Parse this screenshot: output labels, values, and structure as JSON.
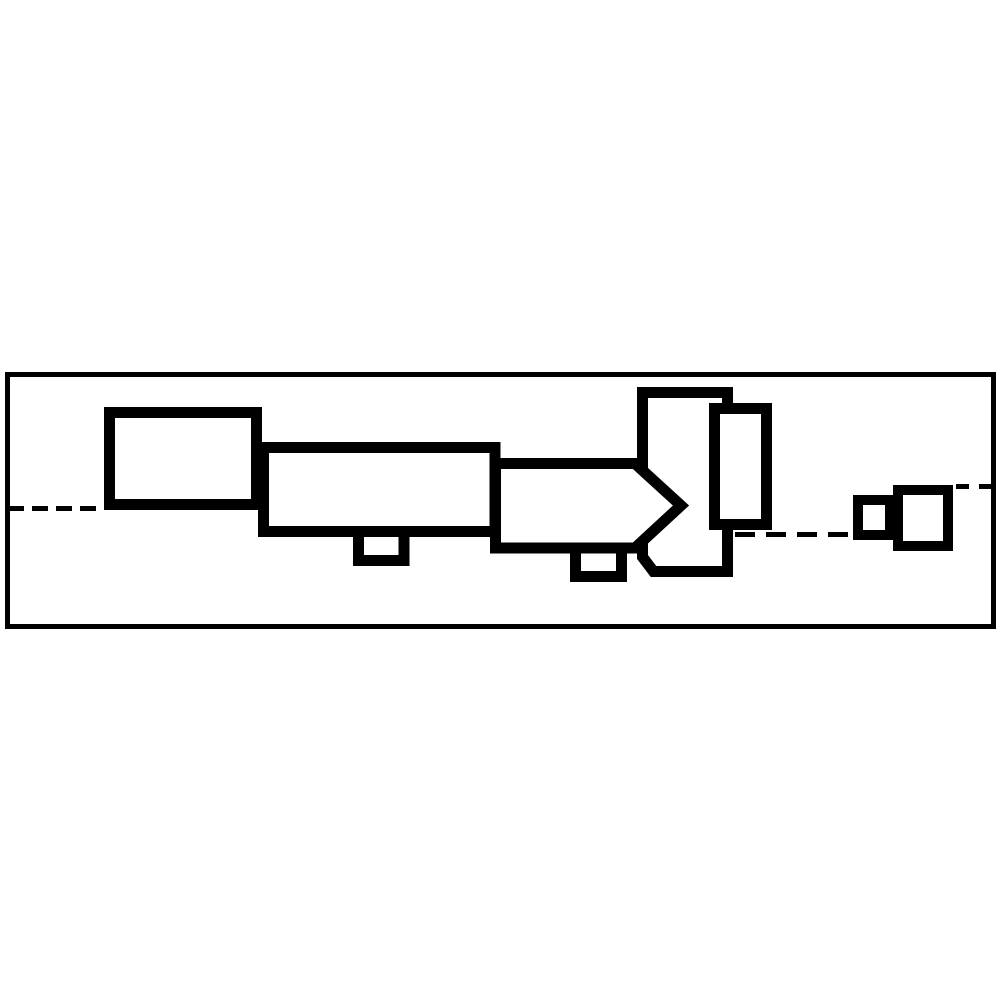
{
  "figure": {
    "canvas": {
      "width": 1000,
      "height": 1000,
      "background": "#ffffff"
    },
    "ink_color": "#000000",
    "border": {
      "x": 7.5,
      "y": 374.5,
      "width": 986,
      "height": 252,
      "stroke_width": 5
    },
    "centerlines": [
      {
        "name": "centerline-left",
        "x1": 8,
        "y1": 508.5,
        "x2": 104,
        "y2": 508.5,
        "dash": "16 8",
        "stroke_width": 5
      },
      {
        "name": "centerline-middle",
        "x1": 735,
        "y1": 534.5,
        "x2": 852,
        "y2": 534.5,
        "dash": "20 11",
        "stroke_width": 5
      },
      {
        "name": "centerline-right",
        "x1": 956,
        "y1": 486.5,
        "x2": 993,
        "y2": 486.5,
        "dash": "13 10",
        "stroke_width": 5
      }
    ],
    "parts": [
      {
        "name": "body-block",
        "type": "polygon",
        "points": "642.5,392.5 727.5,392.5 727.5,571.5 653.5,571.5 642.5,557",
        "stroke_width": 11,
        "fill": "#ffffff"
      },
      {
        "name": "lug-under-arrow",
        "type": "path",
        "d": "M575.5,549 L575.5,576.5 L621.5,576.5 L621.5,549",
        "stroke_width": 11,
        "fill": "none"
      },
      {
        "name": "arrow-block",
        "type": "polygon",
        "points": "495.5,463.5 635,463.5 681,505.5 635,548 495.5,548",
        "stroke_width": 11,
        "fill": "#ffffff"
      },
      {
        "name": "tall-plate",
        "type": "rect",
        "x": 714.5,
        "y": 408.5,
        "width": 52,
        "height": 116,
        "stroke_width": 11,
        "fill": "#ffffff"
      },
      {
        "name": "lug-under-mid",
        "type": "path",
        "d": "M358.5,533 L358.5,560.5 L404,560.5 L404,533",
        "stroke_width": 11,
        "fill": "none"
      },
      {
        "name": "mid-block",
        "type": "rect",
        "x": 263.5,
        "y": 447.5,
        "width": 231.5,
        "height": 84,
        "stroke_width": 11,
        "fill": "#ffffff"
      },
      {
        "name": "left-block",
        "type": "rect",
        "x": 109.5,
        "y": 412.5,
        "width": 147,
        "height": 92,
        "stroke_width": 11,
        "fill": "#ffffff"
      },
      {
        "name": "small-end-block",
        "type": "rect",
        "x": 858,
        "y": 500,
        "width": 32,
        "height": 35,
        "stroke_width": 10,
        "fill": "#ffffff"
      },
      {
        "name": "large-end-block",
        "type": "rect",
        "x": 898,
        "y": 490,
        "width": 50,
        "height": 56,
        "stroke_width": 10,
        "fill": "#ffffff"
      }
    ]
  }
}
